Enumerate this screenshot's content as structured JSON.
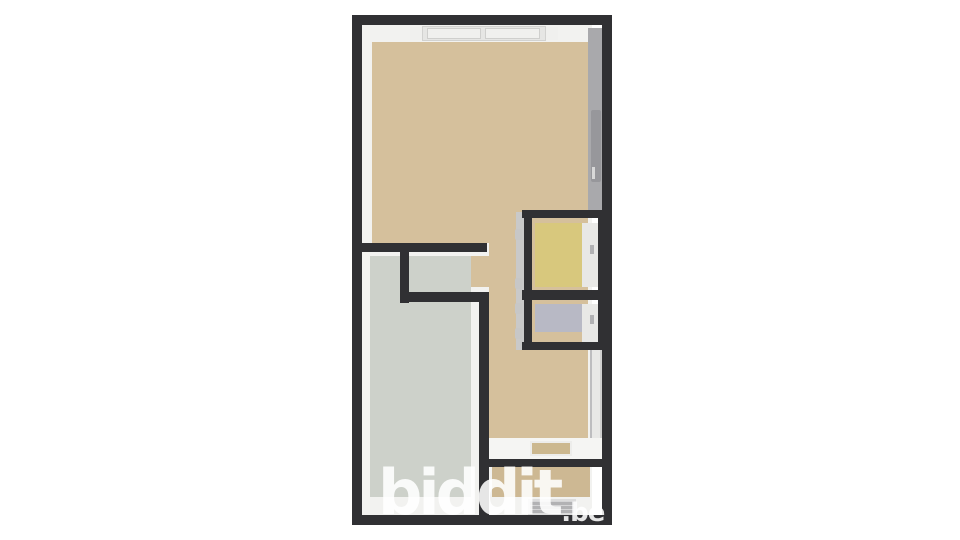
{
  "watermark": {
    "text": "biddit",
    "suffix": ".be"
  },
  "palette": {
    "wall": "#303033",
    "floor_main": "#d5c09c",
    "floor_main_dark": "#cdb893",
    "floor_left_room": "#cdd1ca",
    "floor_yellow_room": "#d8c87d",
    "floor_lavender_room": "#b8b9c5",
    "wall_face_white": "#f2f2f0",
    "wall_face_gray": "#a9a9ac",
    "block_face_gray": "#c9c9c9",
    "door_leaf": "#97979b",
    "landing": "#f5f5f3",
    "landing_inset": "#ccb88f",
    "hatch": "#b2b2b4",
    "hinge": "#c7c7c7",
    "window_frame": "#e6e6e4",
    "window_pane": "#f0f0ee",
    "face_light": "#e8e8e6",
    "watermark_color": "#ffffff"
  }
}
